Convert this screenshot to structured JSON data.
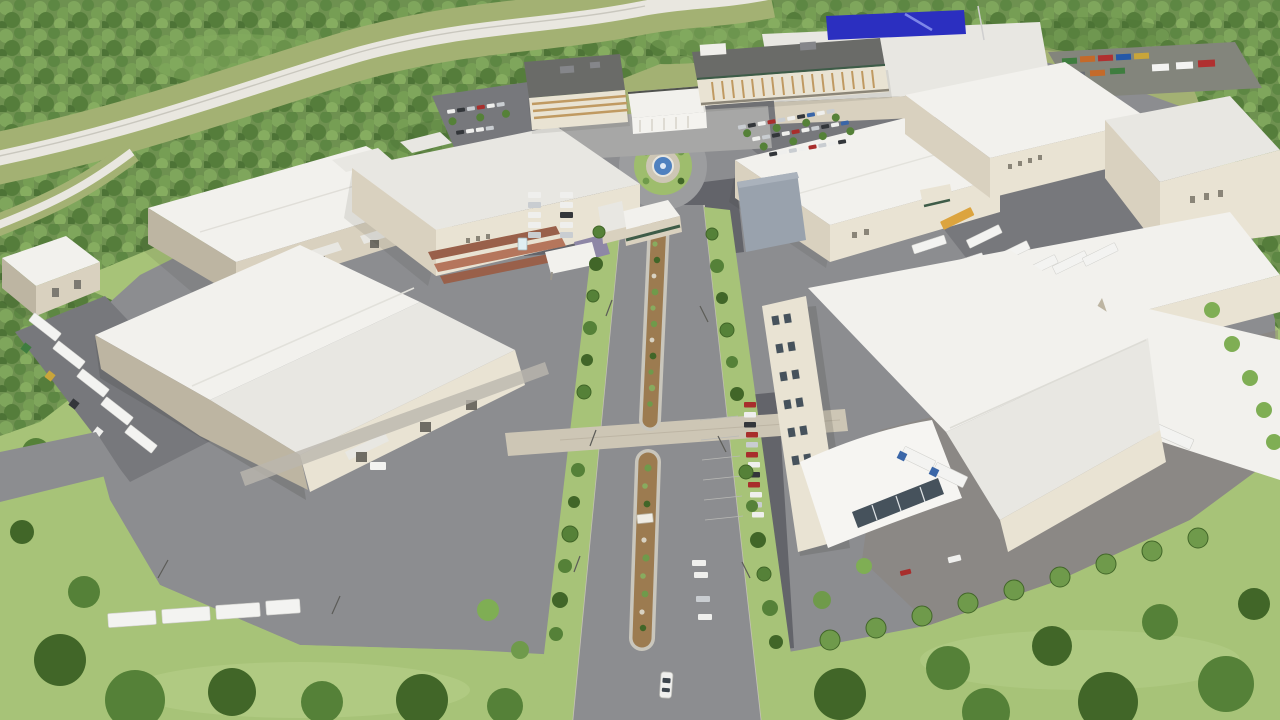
{
  "meta": {
    "description": "Aerial 3D architectural rendering of a master-planned industrial business park: white-roofed warehouses and soundstages around a landscaped central boulevard with an entry roundabout and fountain, two headquarters office buildings at the top, surface parking lots, truck yards with white semi-trailers, all surrounded by dense green forest with a curving highway at the top left and lawns with trees at the bottom."
  },
  "scene": {
    "setting": "daytime bird's-eye view, computer-generated visualization, no visible text or signage lettering",
    "landmarks": [
      "forest-belt",
      "curving-highway",
      "entry-roundabout-with-fountain",
      "landscaped-median-boulevard",
      "office-building-west",
      "office-building-east",
      "entry-pavilion",
      "warehouse-cluster",
      "truck-yard-east",
      "container-yard-northeast",
      "surface-parking-lots",
      "south-lawn-with-tree-row",
      "white-car-driving-south"
    ],
    "vehicles": "white semi-trailers and box trucks at docks and yards, mixed passenger cars (white, silver, dark, red) in parking rows, one white car driving down the boulevard",
    "notable_colors": "blue billboard on north warehouse, blue fountain water, rust-red shed roofs, shipping containers in green/orange/red/blue"
  },
  "palette": {
    "meadow": "#a3b173",
    "grass": "#a7c378",
    "grass-bright": "#b9d18c",
    "forest": "#6e9150",
    "forest-1": "#7fa65c",
    "forest-2": "#5d8743",
    "forest-3": "#769e54",
    "forest-4": "#557d3b",
    "forest-5": "#86ad60",
    "forest-6": "#4d7336",
    "highway": "#e9e7e0",
    "asphalt": "#8c8d90",
    "asphalt-mid": "#77787c",
    "asphalt-dark": "#63646a",
    "pavement-warm": "#8a8176",
    "paver": "#cdc6b5",
    "concrete": "#bab7ae",
    "wall": "#d9d1bf",
    "wall-bright": "#e9e3d3",
    "wall-shade": "#bdb5a2",
    "roof": "#f2f1ed",
    "roof-mid": "#e8e7e2",
    "roof-dark": "#d9d8d3",
    "roof-office": "#6a6b68",
    "window-tan": "#c09a62",
    "glass": "#46525c",
    "fountain-water": "#4f81bf",
    "sign-blue": "#2b2fc0",
    "mulch": "#9c7b50",
    "shrub": "#6f9a4b",
    "tree": "#558138",
    "tree-dark": "#416628",
    "tree-light": "#7fae54",
    "truck-white": "#f3f3f1",
    "truck-orange": "#dca43e",
    "car-red": "#a82e2c",
    "car-dark": "#33363a",
    "car-silver": "#c9cdd1",
    "car-white": "#efefed",
    "car-blue": "#3a66a8",
    "rust-roof": "#99604a",
    "purple-roof": "#8e87a6",
    "green-trim": "#3e5c48",
    "shadow": "#2f312c"
  }
}
